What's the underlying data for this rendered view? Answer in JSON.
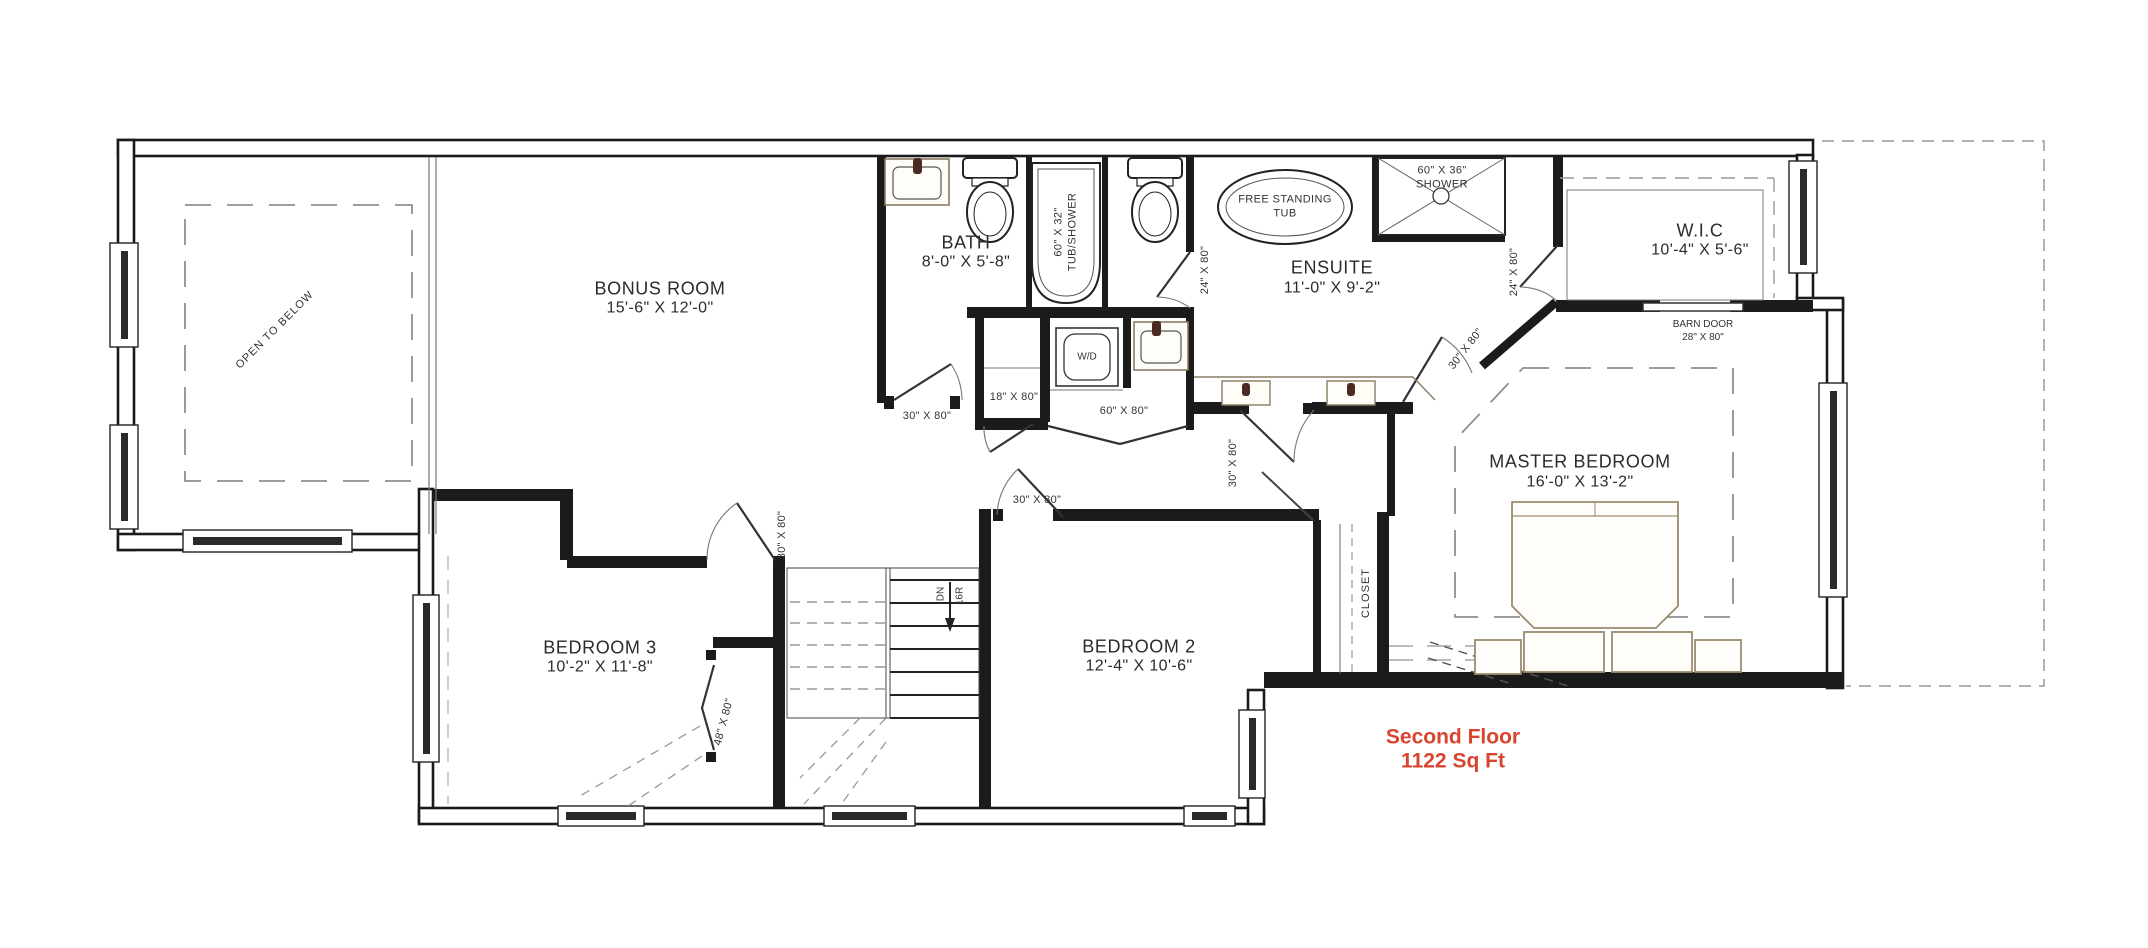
{
  "plan": {
    "floor_label": "Second Floor",
    "area_label": "1122 Sq Ft",
    "accent_color": "#d9442f"
  },
  "rooms": {
    "bonus_room": {
      "name": "BONUS ROOM",
      "dims": "15'-6\" X 12'-0\""
    },
    "bath": {
      "name": "BATH",
      "dims": "8'-0\" X 5'-8\""
    },
    "ensuite": {
      "name": "ENSUITE",
      "dims": "11'-0\" X 9'-2\""
    },
    "wic": {
      "name": "W.I.C",
      "dims": "10'-4\" X 5'-6\""
    },
    "master_bedroom": {
      "name": "MASTER BEDROOM",
      "dims": "16'-0\" X 13'-2\""
    },
    "bedroom2": {
      "name": "BEDROOM 2",
      "dims": "12'-4\" X 10'-6\""
    },
    "bedroom3": {
      "name": "BEDROOM 3",
      "dims": "10'-2\" X 11'-8\""
    }
  },
  "annotations": {
    "open_to_below": "OPEN TO BELOW",
    "closet": "CLOSET",
    "washer_dryer": "W/D",
    "stairs_direction": "DN",
    "stairs_risers": "16R",
    "barn_door_name": "BARN DOOR",
    "barn_door_size": "28\" X 80\""
  },
  "fixtures": {
    "tub_shower_size": "60\" X 32\"",
    "tub_shower_name": "TUB/SHOWER",
    "free_standing_tub_line1": "FREE STANDING",
    "free_standing_tub_line2": "TUB",
    "shower_size": "60\" X 36\"",
    "shower_name": "SHOWER"
  },
  "door_sizes": {
    "door_30": "30\" X 80\"",
    "door_18": "18\" X 80\"",
    "door_60": "60\" X 80\"",
    "door_24": "24\" X 80\"",
    "door_48": "48\" X 80\""
  }
}
